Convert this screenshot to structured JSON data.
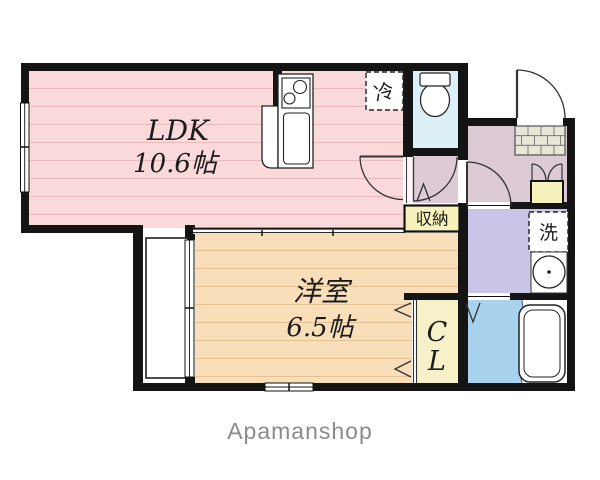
{
  "floorplan": {
    "rooms": {
      "ldk": {
        "name": "LDK",
        "size": "10.6帖"
      },
      "western_room": {
        "name": "洋室",
        "size": "6.5帖"
      },
      "closet": {
        "label_line1": "C",
        "label_line2": "L"
      },
      "storage": {
        "label": "収納"
      }
    },
    "fixtures": {
      "refrigerator": {
        "label": "冷"
      },
      "washing_machine": {
        "label": "洗"
      }
    },
    "colors": {
      "ldk_floor": "#f9d9da",
      "western_floor": "#f8dfb9",
      "closet_fill": "#f6f1c9",
      "storage_fill": "#f7f2bb",
      "toilet_fill": "#ddeff7",
      "washroom_fill": "#c9c5e7",
      "bathroom_fill": "#a9d2ef",
      "hallway_fill": "#dccad4",
      "wall": "#141414"
    }
  },
  "footer": {
    "brand": "Apamanshop"
  }
}
